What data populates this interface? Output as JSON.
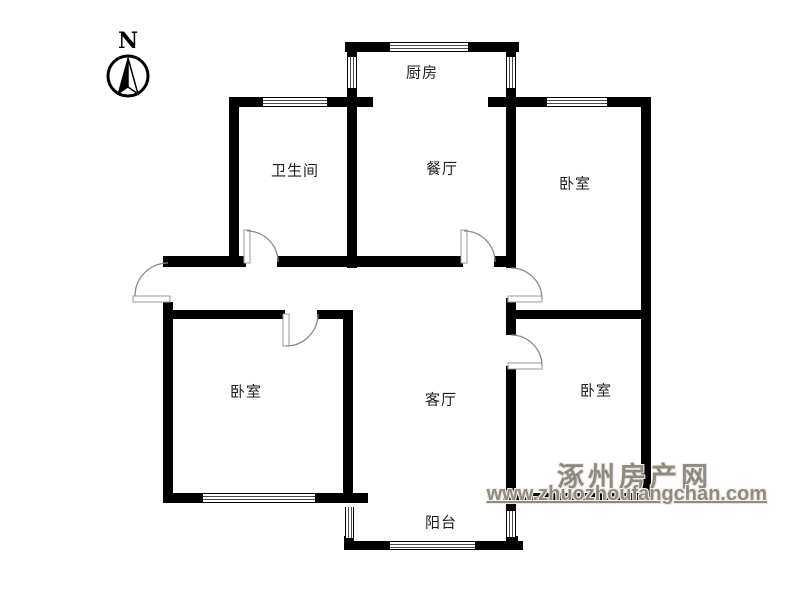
{
  "compass": {
    "label": "N"
  },
  "rooms": {
    "kitchen": {
      "label": "厨房"
    },
    "bathroom": {
      "label": "卫生间"
    },
    "dining": {
      "label": "餐厅"
    },
    "bedroom_ne": {
      "label": "卧室"
    },
    "bedroom_sw": {
      "label": "卧室"
    },
    "living": {
      "label": "客厅"
    },
    "bedroom_se": {
      "label": "卧室"
    },
    "balcony": {
      "label": "阳台"
    }
  },
  "watermark": {
    "site_name": "涿州房产网",
    "url": "www.zhuozhoufangchan.com"
  },
  "colors": {
    "wall": "#000000",
    "door_arc": "#8a8a8a",
    "watermark_text": "#8f8a82",
    "label_text": "#1f1f1f",
    "background": "#ffffff"
  }
}
